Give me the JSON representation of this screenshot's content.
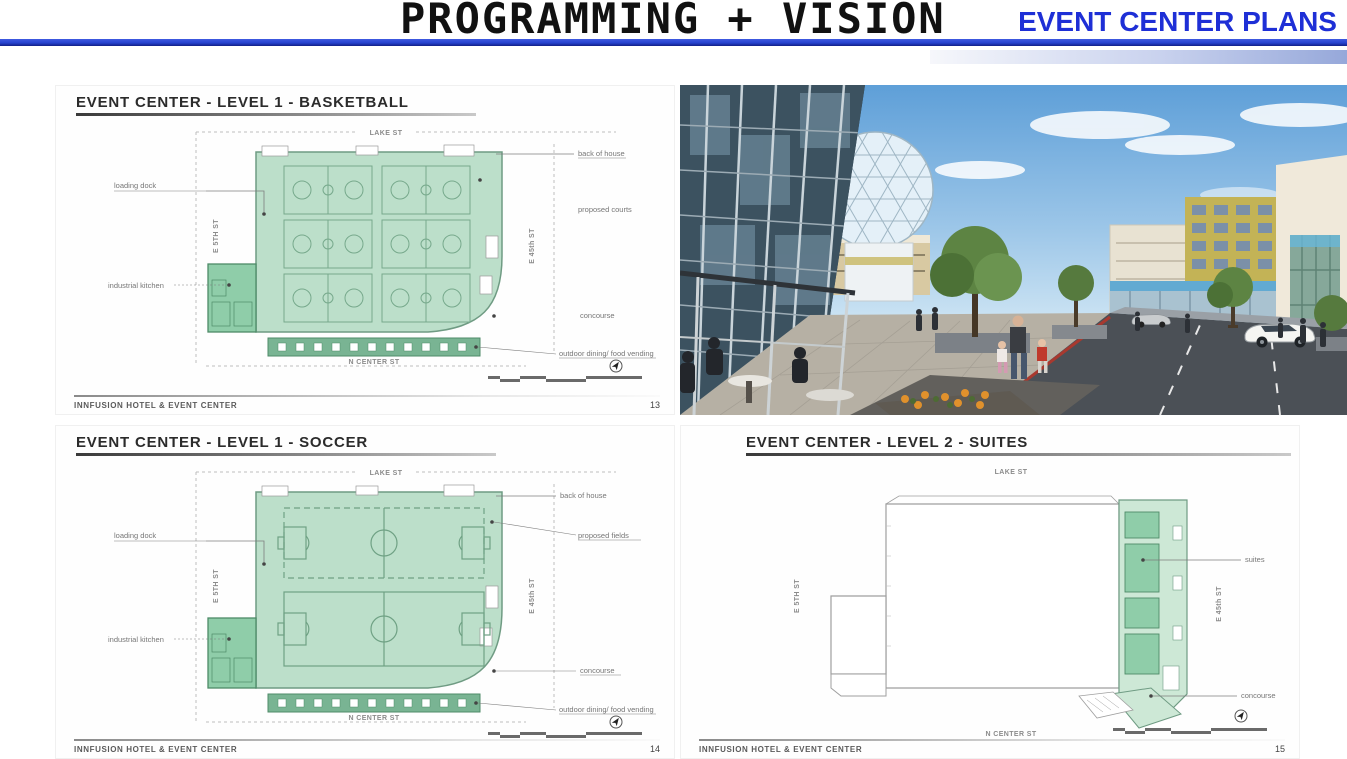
{
  "colors": {
    "accent_blue": "#1e2fd6",
    "rule_blue": "#2743cf",
    "plan_green_light": "#bcdfca",
    "plan_green_mid": "#8fcda9",
    "plan_green_dark": "#79b493"
  },
  "header": {
    "title": "PROGRAMMING + VISION",
    "subtitle": "EVENT CENTER PLANS"
  },
  "plans": {
    "basketball": {
      "heading": "EVENT CENTER - LEVEL 1 - BASKETBALL",
      "street_top": "LAKE ST",
      "street_left": "E 5TH ST",
      "street_right": "E 45th ST",
      "street_bottom": "N CENTER ST",
      "label_loading_dock": "loading dock",
      "label_kitchen": "industrial kitchen",
      "label_back_of_house": "back of house",
      "label_courts": "proposed courts",
      "label_concourse": "concourse",
      "label_outdoor": "outdoor dining/ food vending",
      "footer": "INNFUSION HOTEL & EVENT CENTER",
      "page": "13"
    },
    "soccer": {
      "heading": "EVENT CENTER - LEVEL 1 - SOCCER",
      "street_top": "LAKE ST",
      "street_left": "E 5TH ST",
      "street_right": "E 45th ST",
      "street_bottom": "N CENTER ST",
      "label_loading_dock": "loading dock",
      "label_kitchen": "industrial kitchen",
      "label_back_of_house": "back of house",
      "label_courts": "proposed fields",
      "label_concourse": "concourse",
      "label_outdoor": "outdoor dining/ food vending",
      "footer": "INNFUSION HOTEL & EVENT CENTER",
      "page": "14"
    },
    "suites": {
      "heading": "EVENT CENTER - LEVEL 2 - SUITES",
      "street_top": "LAKE ST",
      "street_left": "E 5TH ST",
      "street_right": "E 45th ST",
      "street_bottom": "N CENTER ST",
      "label_suites": "suites",
      "label_concourse": "concourse",
      "footer": "INNFUSION HOTEL & EVENT CENTER",
      "page": "15"
    }
  }
}
